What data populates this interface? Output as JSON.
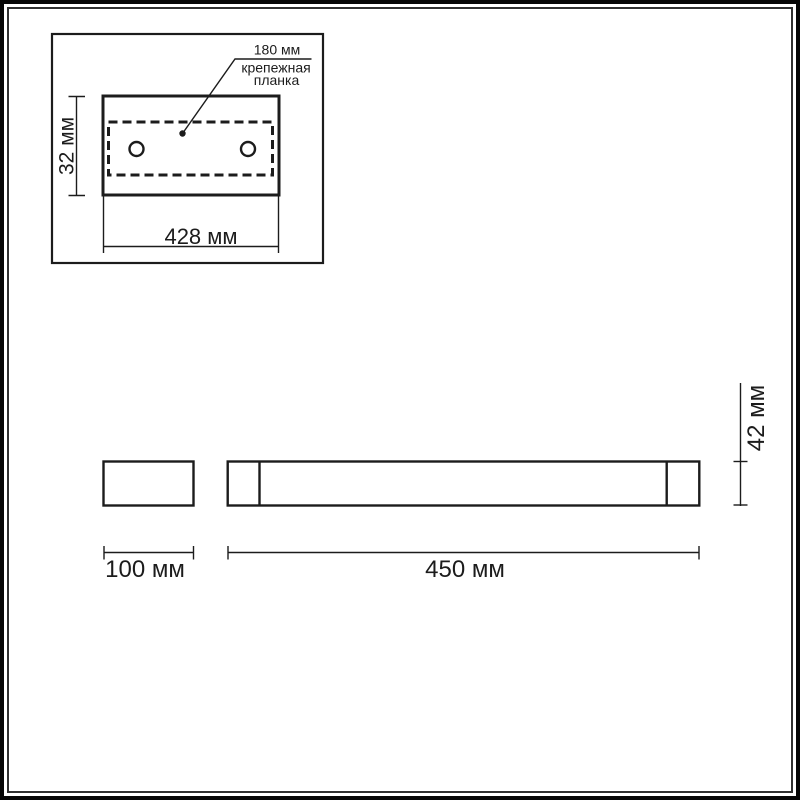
{
  "colors": {
    "line": "#1c1c1c",
    "background": "#ffffff",
    "frame_outer": "#060606",
    "frame_inner": "#303030"
  },
  "top_view": {
    "annotation": {
      "dim": "180 мм",
      "label_line1": "крепежная",
      "label_line2": "планка"
    },
    "height_dim": "32 мм",
    "width_dim": "428 мм"
  },
  "side_view": {
    "left_section_dim": "100 мм",
    "body_dim": "450 мм",
    "height_dim": "42 мм"
  }
}
